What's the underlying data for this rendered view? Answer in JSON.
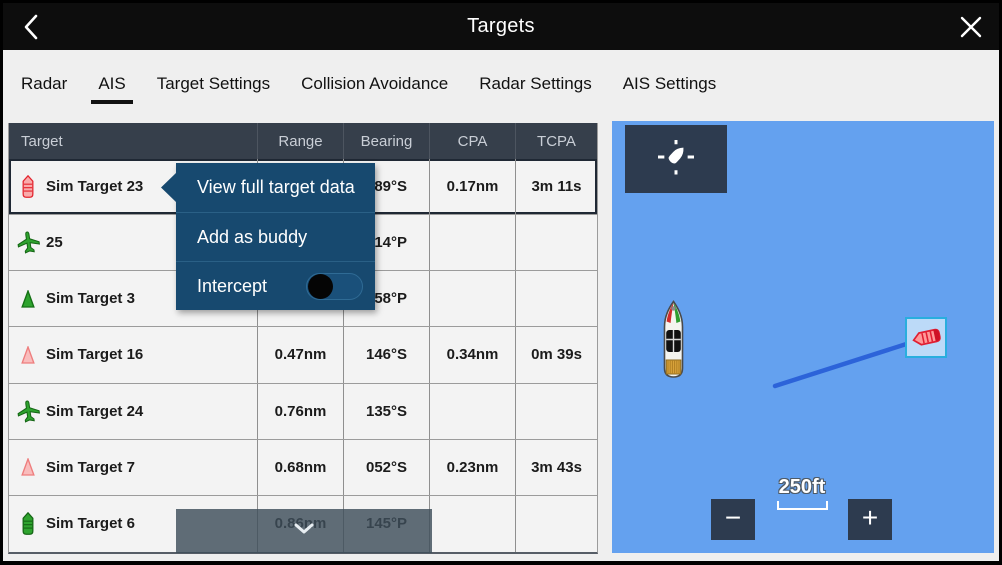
{
  "header": {
    "title": "Targets",
    "back_glyph": "‹",
    "close_glyph": "✕"
  },
  "tabs": [
    {
      "label": "Radar",
      "active": false
    },
    {
      "label": "AIS",
      "active": true
    },
    {
      "label": "Target Settings",
      "active": false
    },
    {
      "label": "Collision Avoidance",
      "active": false
    },
    {
      "label": "Radar Settings",
      "active": false
    },
    {
      "label": "AIS Settings",
      "active": false
    }
  ],
  "table": {
    "columns": [
      "Target",
      "Range",
      "Bearing",
      "CPA",
      "TCPA"
    ],
    "rows": [
      {
        "icon": "vessel-red-icon",
        "name": "Sim Target 23",
        "range": "",
        "bearing": "089°S",
        "cpa": "0.17nm",
        "tcpa": "3m 11s",
        "selected": true
      },
      {
        "icon": "aircraft-green-icon",
        "name": "25",
        "range": "",
        "bearing": "014°P",
        "cpa": "",
        "tcpa": ""
      },
      {
        "icon": "triangle-green-icon",
        "name": "Sim Target 3",
        "range": "",
        "bearing": "058°P",
        "cpa": "",
        "tcpa": ""
      },
      {
        "icon": "triangle-pink-icon",
        "name": "Sim Target 16",
        "range": "0.47nm",
        "bearing": "146°S",
        "cpa": "0.34nm",
        "tcpa": "0m 39s"
      },
      {
        "icon": "aircraft-green-icon",
        "name": "Sim Target 24",
        "range": "0.76nm",
        "bearing": "135°S",
        "cpa": "",
        "tcpa": ""
      },
      {
        "icon": "triangle-pink-icon",
        "name": "Sim Target 7",
        "range": "0.68nm",
        "bearing": "052°S",
        "cpa": "0.23nm",
        "tcpa": "3m 43s"
      },
      {
        "icon": "vessel-green-icon",
        "name": "Sim Target 6",
        "range": "0.86nm",
        "bearing": "145°P",
        "cpa": "",
        "tcpa": ""
      }
    ]
  },
  "context_menu": {
    "items": [
      {
        "label": "View full target data"
      },
      {
        "label": "Add as buddy"
      },
      {
        "label": "Intercept",
        "toggle_state": "off"
      }
    ]
  },
  "scroll_more": {
    "icon": "chevron-down-icon"
  },
  "map": {
    "locate_icon": "vessel-locate-icon",
    "own_vessel_icon": "own-vessel-icon",
    "target_icon": "ais-target-red-icon",
    "scale_label": "250ft",
    "zoom_out_glyph": "−",
    "zoom_in_glyph": "+"
  },
  "colors": {
    "map_blue": "#64a1ef",
    "menu_navy": "#17496f",
    "table_header_slate": "#363f4b",
    "target_box_cyan": "#29aede",
    "cog_line_blue": "#2c63d9"
  }
}
